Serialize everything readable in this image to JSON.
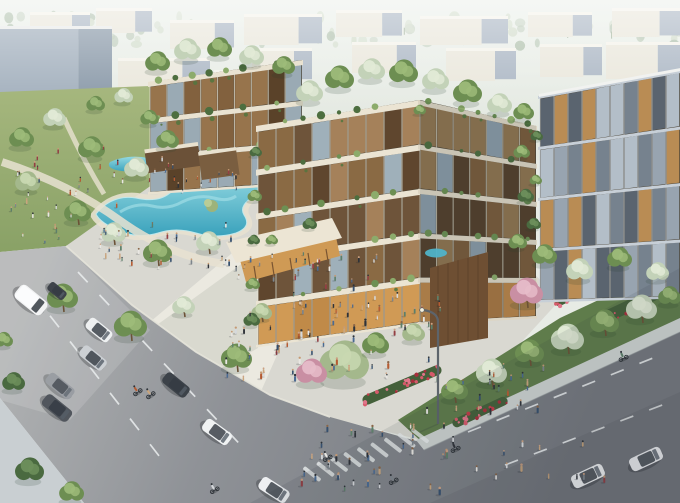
{
  "scene": {
    "type": "architectural-rendering",
    "subject": "Aerial view of a modern mixed-use residential complex with terraced green balconies, rooftop gardens, a lagoon pool park, pedestrian plazas, and street traffic",
    "view": "aerial three-quarter perspective",
    "lighting": "late-afternoon sun, hazy horizon"
  },
  "palette": {
    "sky_top": "#ebf0ea",
    "sky_bottom": "#e1e6de",
    "distant_face": "#e9e6da",
    "distant_side": "#a7b3c1",
    "grass_light": "#a6b77e",
    "grass_dark": "#7d985c",
    "lagoon_light": "#93d8e1",
    "lagoon_deep": "#3aa2bc",
    "pavement": "#d9d8d1",
    "road_light": "#b0b2b3",
    "road_dark": "#73777d",
    "slab_cream": "#ebe4d3",
    "wood_warm": "#8a6a44",
    "glass_warm": "#d09a55",
    "panel_cool": "#98a4b0",
    "flower_red": "#c23b49",
    "tree_tones": {
      "green": [
        "#6d8e52",
        "#9dbb79"
      ],
      "pale": [
        "#c3d2b8",
        "#e2ead6"
      ],
      "sage": [
        "#a4b88c",
        "#c9d8b2"
      ],
      "dark": [
        "#4a6a40",
        "#6d8f5c"
      ],
      "pink": [
        "#c98fa3",
        "#e6bcc9"
      ]
    }
  },
  "distant": {
    "buildings": [
      [
        30,
        12,
        60,
        26
      ],
      [
        96,
        8,
        56,
        22
      ],
      [
        170,
        20,
        64,
        26
      ],
      [
        244,
        14,
        78,
        28
      ],
      [
        336,
        10,
        66,
        24
      ],
      [
        420,
        16,
        88,
        26
      ],
      [
        528,
        12,
        64,
        22
      ],
      [
        612,
        8,
        68,
        26
      ],
      [
        0,
        26,
        112,
        82,
        "bluegray"
      ],
      [
        118,
        58,
        92,
        48
      ],
      [
        214,
        70,
        58,
        30
      ],
      [
        252,
        48,
        60,
        30
      ],
      [
        352,
        42,
        64,
        28
      ],
      [
        446,
        48,
        70,
        30
      ],
      [
        540,
        44,
        62,
        30
      ],
      [
        606,
        42,
        74,
        34
      ],
      [
        636,
        80,
        44,
        28
      ]
    ],
    "flora_band": {
      "y0": 15,
      "y1": 46,
      "n": 90
    }
  },
  "facades": [
    {
      "target": "g-faceC",
      "x1": 150,
      "y1t": 82,
      "y1b": 192,
      "x2": 302,
      "y2t": 60,
      "y2b": 182,
      "floors": 3,
      "slabH": 5,
      "bayW": 17,
      "slab": "#e9e2d1",
      "tones": [
        "#82613e",
        "#5a4229",
        "#97744c",
        "#9aaab4"
      ],
      "fringe": true,
      "seed": 5
    },
    {
      "target": "g-faceA",
      "x1": 258,
      "y1t": 126,
      "y1b": 345,
      "x2": 420,
      "y2t": 100,
      "y2b": 322,
      "floors": 5,
      "slabH": 6,
      "bayW": 18,
      "slab": "#ebe4d3",
      "tones": [
        "#8a6a44",
        "#5f462e",
        "#a5815a",
        "#9fb0ba",
        "#6e543a"
      ],
      "groundTones": [
        "#d09a55",
        "#c08a48",
        "#e2ae66"
      ],
      "fringe": true,
      "seed": 7
    },
    {
      "target": "g-faceB",
      "x1": 420,
      "y1t": 100,
      "y1b": 322,
      "x2": 536,
      "y2t": 126,
      "y2b": 316,
      "floors": 5,
      "slabH": 5,
      "bayW": 16,
      "slab": "#ddd5c3",
      "tones": [
        "#7a5c3c",
        "#54402c",
        "#8f7450",
        "#8a9aa6"
      ],
      "groundTones": [
        "#b9854a",
        "#a87742"
      ],
      "shade": 0.1,
      "fringe": true,
      "seed": 11
    },
    {
      "target": "g-faceD",
      "x1": 540,
      "y1t": 96,
      "y1b": 300,
      "x2": 680,
      "y2t": 70,
      "y2b": 296,
      "floors": 4,
      "slabH": 3,
      "bayW": 14,
      "slab": "#c7cfd7",
      "tones": [
        "#5a646f",
        "#76828e",
        "#98a4b0",
        "#b3bec8",
        "#b98c54"
      ],
      "topEdge": true,
      "fringe": false,
      "seed": 9
    }
  ],
  "landscape": {
    "back_trees": [
      [
        124,
        96,
        9,
        "pale"
      ],
      [
        96,
        104,
        9,
        "green"
      ],
      [
        205,
        100,
        9,
        "green"
      ],
      [
        240,
        106,
        8,
        "pale"
      ]
    ],
    "front_trees": [
      [
        310,
        92,
        13,
        "pale"
      ],
      [
        340,
        78,
        14,
        "green"
      ],
      [
        372,
        70,
        13,
        "pale"
      ],
      [
        404,
        72,
        14,
        "green"
      ],
      [
        436,
        80,
        13,
        "pale"
      ],
      [
        468,
        92,
        14,
        "green"
      ],
      [
        500,
        104,
        12,
        "pale"
      ],
      [
        524,
        112,
        10,
        "green"
      ],
      [
        158,
        62,
        12,
        "green"
      ],
      [
        188,
        50,
        13,
        "pale"
      ],
      [
        220,
        48,
        12,
        "green"
      ],
      [
        252,
        56,
        12,
        "pale"
      ],
      [
        284,
        66,
        11,
        "green"
      ],
      [
        22,
        138,
        12,
        "green"
      ],
      [
        55,
        118,
        11,
        "pale"
      ],
      [
        92,
        148,
        13,
        "green"
      ],
      [
        137,
        168,
        12,
        "pale"
      ],
      [
        168,
        140,
        11,
        "green"
      ],
      [
        28,
        182,
        12,
        "sage"
      ],
      [
        150,
        118,
        9,
        "green"
      ],
      [
        78,
        212,
        13,
        "green",
        1
      ],
      [
        114,
        233,
        12,
        "pale",
        1
      ],
      [
        158,
        252,
        14,
        "green",
        1
      ],
      [
        209,
        242,
        12,
        "pale",
        1
      ],
      [
        63,
        297,
        15,
        "green",
        1
      ],
      [
        131,
        325,
        16,
        "green",
        1
      ],
      [
        184,
        306,
        11,
        "pale",
        1
      ],
      [
        237,
        357,
        15,
        "green",
        1
      ],
      [
        262,
        312,
        10,
        "sage",
        1
      ],
      [
        14,
        382,
        11,
        "dark"
      ],
      [
        30,
        470,
        14,
        "dark"
      ],
      [
        72,
        492,
        12,
        "green"
      ],
      [
        4,
        340,
        9,
        "green"
      ],
      [
        455,
        390,
        13,
        "green",
        1
      ],
      [
        492,
        372,
        15,
        "pale",
        1
      ],
      [
        530,
        352,
        14,
        "green",
        1
      ],
      [
        568,
        338,
        16,
        "pale",
        1
      ],
      [
        605,
        322,
        14,
        "green",
        1
      ],
      [
        642,
        308,
        15,
        "pale",
        1
      ],
      [
        670,
        296,
        11,
        "green"
      ],
      [
        545,
        255,
        12,
        "green"
      ],
      [
        580,
        270,
        13,
        "pale"
      ],
      [
        620,
        258,
        12,
        "green"
      ],
      [
        658,
        272,
        11,
        "pale"
      ],
      [
        527,
        292,
        16,
        "pink",
        1
      ],
      [
        256,
        152,
        6,
        "dark"
      ],
      [
        255,
        196,
        7,
        "green"
      ],
      [
        254,
        240,
        6,
        "dark"
      ],
      [
        253,
        284,
        7,
        "green"
      ],
      [
        252,
        320,
        8,
        "dark"
      ],
      [
        420,
        110,
        6,
        "green"
      ],
      [
        537,
        136,
        6,
        "dark"
      ],
      [
        536,
        180,
        6,
        "green"
      ],
      [
        534,
        224,
        7,
        "dark"
      ],
      [
        522,
        152,
        8,
        "green"
      ],
      [
        526,
        196,
        8,
        "dark"
      ],
      [
        518,
        242,
        9,
        "green"
      ],
      [
        310,
        224,
        7,
        "dark"
      ],
      [
        272,
        240,
        6,
        "green"
      ]
    ],
    "bushes": [
      [
        345,
        362,
        24,
        "sage"
      ],
      [
        312,
        372,
        15,
        "pink"
      ],
      [
        376,
        344,
        13,
        "green"
      ],
      [
        414,
        333,
        11,
        "sage"
      ]
    ],
    "flower_beds": [
      [
        402,
        385,
        85,
        10,
        -23
      ],
      [
        480,
        412,
        60,
        9,
        -25
      ],
      [
        638,
        302,
        85,
        12,
        -25
      ],
      [
        573,
        295,
        40,
        9,
        -25
      ]
    ],
    "street_lights": [
      {
        "x": 438,
        "y_base": 424,
        "y_top": 312,
        "arm_dx": -15,
        "arm_dy": -10
      }
    ]
  },
  "traffic": {
    "cars": [
      [
        31,
        300,
        39,
        34,
        17,
        "#f2f3f4",
        "van"
      ],
      [
        57,
        291,
        39,
        20,
        10,
        "#3e434a",
        "car"
      ],
      [
        99,
        330,
        39,
        28,
        13,
        "#eef0f1",
        "car"
      ],
      [
        93,
        358,
        39,
        29,
        13,
        "#ccd0d4",
        "car"
      ],
      [
        60,
        386,
        39,
        31,
        13,
        "#969aa0",
        "car",
        0.85
      ],
      [
        57,
        408,
        39,
        32,
        14,
        "#51565d",
        "car"
      ],
      [
        176,
        385,
        39,
        29,
        13,
        "#3c4249",
        "car"
      ],
      [
        217,
        432,
        36,
        31,
        14,
        "#f0f2f3",
        "car"
      ],
      [
        274,
        490,
        33,
        32,
        14,
        "#eef0f2",
        "car"
      ],
      [
        588,
        476,
        -25,
        34,
        14,
        "#f1f3f4",
        "car"
      ],
      [
        646,
        459,
        -25,
        34,
        14,
        "#eef0f2",
        "car"
      ]
    ],
    "bikes": [
      [
        137,
        391,
        -35
      ],
      [
        150,
        394,
        -35
      ],
      [
        214,
        489,
        -30
      ],
      [
        327,
        457,
        -28
      ],
      [
        393,
        480,
        -28
      ],
      [
        623,
        357,
        -25
      ],
      [
        455,
        448,
        -25
      ]
    ],
    "dash_lines": [
      [
        30,
        290,
        170,
        470,
        7
      ],
      [
        78,
        272,
        250,
        455,
        8
      ],
      [
        468,
        432,
        668,
        352,
        7
      ],
      [
        505,
        465,
        678,
        399,
        6
      ]
    ],
    "crosswalk": {
      "x": 312,
      "y": 474,
      "n": 9,
      "sx": 13.5,
      "sy": -4.8,
      "len": 21,
      "wid": 4,
      "ang": 38
    }
  },
  "crowds": {
    "person_colors": [
      "#2f3339",
      "#e9e7e3",
      "#b65c33",
      "#4a6a92",
      "#7d858c",
      "#c9a57d",
      "#943f44",
      "#5d7f6a",
      "#d6d9dc",
      "#36506e"
    ],
    "clusters": [
      {
        "x": 8,
        "y": 148,
        "w": 185,
        "h": 60,
        "n": 26,
        "s": 0.8,
        "seed": 101
      },
      {
        "x": 92,
        "y": 222,
        "w": 145,
        "h": 50,
        "n": 30,
        "s": 0.85,
        "seed": 102
      },
      {
        "x": 232,
        "y": 252,
        "w": 150,
        "h": 66,
        "n": 38,
        "s": 0.9,
        "seed": 103
      },
      {
        "x": 225,
        "y": 322,
        "w": 170,
        "h": 60,
        "n": 44,
        "s": 1.0,
        "seed": 104
      },
      {
        "x": 295,
        "y": 425,
        "w": 160,
        "h": 68,
        "n": 38,
        "s": 1.1,
        "seed": 105
      },
      {
        "x": 425,
        "y": 360,
        "w": 120,
        "h": 54,
        "n": 24,
        "s": 1.0,
        "seed": 106
      },
      {
        "x": 475,
        "y": 438,
        "w": 130,
        "h": 44,
        "n": 12,
        "s": 1.1,
        "seed": 107
      },
      {
        "x": 148,
        "y": 165,
        "w": 95,
        "h": 36,
        "n": 14,
        "s": 0.7,
        "seed": 108
      },
      {
        "x": 330,
        "y": 295,
        "w": 115,
        "h": 40,
        "n": 20,
        "s": 0.9,
        "seed": 109
      },
      {
        "x": 5,
        "y": 205,
        "w": 70,
        "h": 40,
        "n": 10,
        "s": 0.8,
        "seed": 110
      }
    ]
  }
}
